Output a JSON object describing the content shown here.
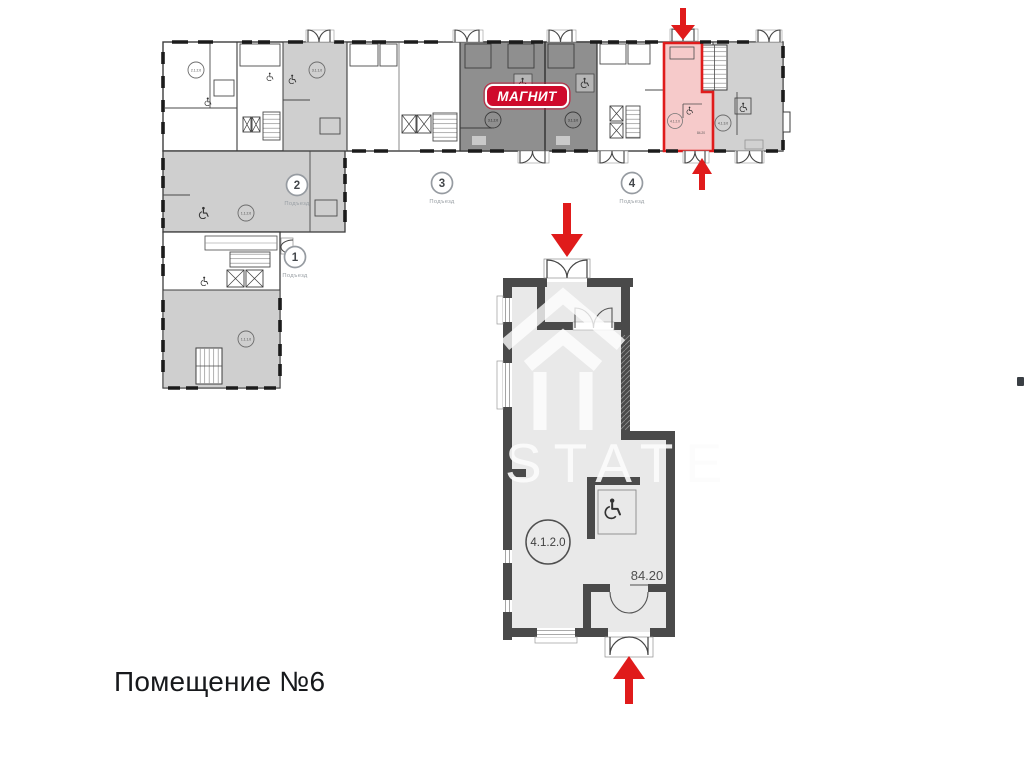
{
  "caption": {
    "text": "Помещение №6"
  },
  "watermark": {
    "text": "STATE"
  },
  "detail_plan": {
    "unit_label": "4.1.2.0",
    "area": "84.20"
  },
  "building": {
    "magnit_label": "МАГНИТ",
    "entrances": {
      "e1": {
        "number": "1",
        "label": "Подъезд"
      },
      "e2": {
        "number": "2",
        "label": "Подъезд"
      },
      "e3": {
        "number": "3",
        "label": "Подъезд"
      },
      "e4": {
        "number": "4",
        "label": "Подъезд"
      }
    },
    "units": {
      "u112": {
        "label": "1.1.2.0"
      },
      "u111": {
        "label": "1.1.1.0"
      },
      "u212": {
        "label": "2.1.2.0"
      },
      "u311": {
        "label": "3.1.1.0"
      },
      "u312": {
        "label": "3.1.2.0"
      },
      "u313": {
        "label": "3.1.3.0"
      },
      "u412": {
        "label": "4.1.2.0",
        "area": "84.20"
      },
      "u413": {
        "label": "4.1.3.0"
      }
    }
  },
  "colors": {
    "highlight_fill": "#f6caca",
    "highlight_stroke": "#e01b1b",
    "arrow_red": "#e01b1b",
    "magnit_red": "#cf0a2c",
    "wall_dark": "#4a4a4a"
  }
}
